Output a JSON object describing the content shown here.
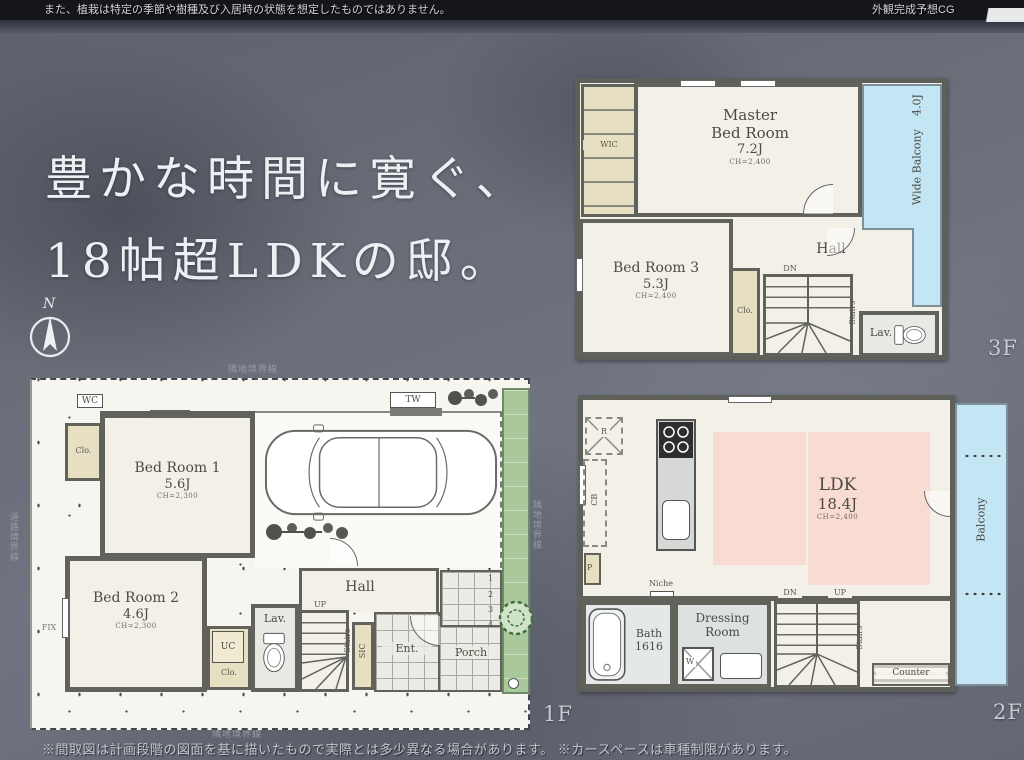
{
  "top_bar": {
    "left": "また、植栽は特定の季節や樹種及び入居時の状態を想定したものではありません。",
    "right": "外観完成予想CG"
  },
  "headline": {
    "line1": "豊かな時間に寛ぐ、",
    "line2": "18帖超LDKの邸。"
  },
  "compass": {
    "n": "N"
  },
  "f3": {
    "floor_label": "3F",
    "wic": "WIC",
    "master_line1": "Master",
    "master_line2": "Bed Room",
    "master_size": "7.2J",
    "master_ch": "CH=2,400",
    "balcony_name": "Wide Balcony",
    "balcony_size": "4.0J",
    "bed3_name": "Bed Room 3",
    "bed3_size": "5.3J",
    "bed3_ch": "CH=2,400",
    "clo": "Clo.",
    "hall": "Hall",
    "dn": "DN",
    "stairs": "Stairs",
    "lav": "Lav."
  },
  "f1": {
    "floor_label": "1F",
    "boundary_top": "隣地境界線",
    "boundary_bottom": "隣地境界線",
    "boundary_left": "道路境界線",
    "boundary_right": "隣地境界線",
    "wc": "WC",
    "tw": "TW",
    "clo_top": "Clo.",
    "bed1_name": "Bed Room 1",
    "bed1_size": "5.6J",
    "bed1_ch": "CH=2,300",
    "bed2_name": "Bed Room 2",
    "bed2_size": "4.6J",
    "bed2_ch": "CH=2,300",
    "fix": "FIX",
    "uc": "UC",
    "clo_uc": "Clo.",
    "lav": "Lav.",
    "hall": "Hall",
    "up": "UP",
    "stairs": "Stairs",
    "sic": "SIC",
    "ent": "Ent.",
    "porch": "Porch",
    "steps": [
      "1",
      "2",
      "3",
      "4"
    ]
  },
  "f2": {
    "floor_label": "2F",
    "r": "R",
    "cb": "CB",
    "p": "P",
    "ldk_name": "LDK",
    "ldk_size": "18.4J",
    "ldk_ch": "CH=2,400",
    "balcony": "Balcony",
    "niche": "Niche",
    "bath_name": "Bath",
    "bath_size": "1616",
    "dress_line1": "Dressing",
    "dress_line2": "Room",
    "w": "W",
    "dn": "DN",
    "up": "UP",
    "stairs": "Stairs",
    "counter": "Counter"
  },
  "footer": {
    "disclaimer": "※間取図は計画段階の図面を基に描いたもので実際とは多少異なる場合があります。 ※カースペースは車種制限があります。"
  },
  "colors": {
    "background": "#6b6f77",
    "topbar": "#14161a",
    "paper": "#f3f0e8",
    "wall": "#62625d",
    "closet_beige": "#e6dfc2",
    "balcony_blue": "#c4e5f3",
    "ldk_pink": "#f8dcd4",
    "garden_green": "#a9c89c",
    "label_ink": "#4b4b44"
  }
}
